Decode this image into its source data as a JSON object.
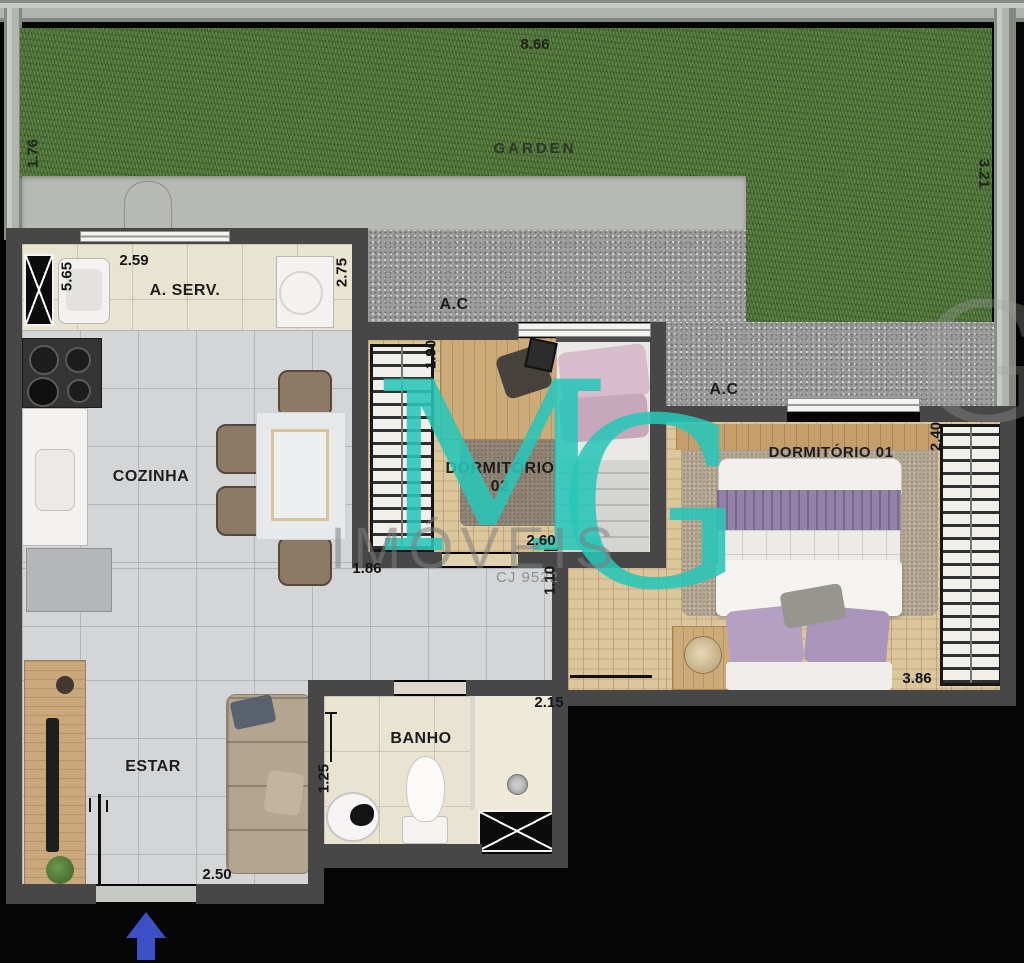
{
  "plan_title": "apartment floor plan",
  "garden": {
    "label": "GARDEN",
    "width": "8.66",
    "left_depth": "1.76",
    "right_depth": "3.21"
  },
  "service_area": {
    "label": "A. SERV.",
    "length": "5.65",
    "width": "2.59",
    "right_width": "2.75"
  },
  "ac_areas": {
    "label_1": "A.C",
    "label_2": "A.C"
  },
  "kitchen": {
    "label": "COZINHA"
  },
  "living": {
    "label": "ESTAR",
    "entry_width": "2.50"
  },
  "bathroom": {
    "label": "BANHO",
    "width": "2.15",
    "depth": "1.25"
  },
  "bedroom2": {
    "label_line1": "DORMITÓRIO",
    "label_line2": "02",
    "closet_width": "1.90",
    "width": "2.60",
    "left_dim": "1.86",
    "hall_width": "1.10"
  },
  "bedroom1": {
    "label": "DORMITÓRIO 01",
    "depth": "2.40",
    "width": "3.86"
  },
  "watermark": {
    "letter_m": "M",
    "letter_g": "G",
    "letter_g_faint": "G",
    "company": "IMÓVEIS",
    "license": "CJ 9522"
  },
  "colors": {
    "wall": "#474747",
    "grass": "#567a40",
    "gravel": "#9c9c9c",
    "tile_gray": "#d3d5d7",
    "tile_beige": "#e9e3d2",
    "wood": "#dcc69c",
    "watermark_teal": "#28c6b8",
    "entrance_arrow_blue": "#3a50c4"
  }
}
